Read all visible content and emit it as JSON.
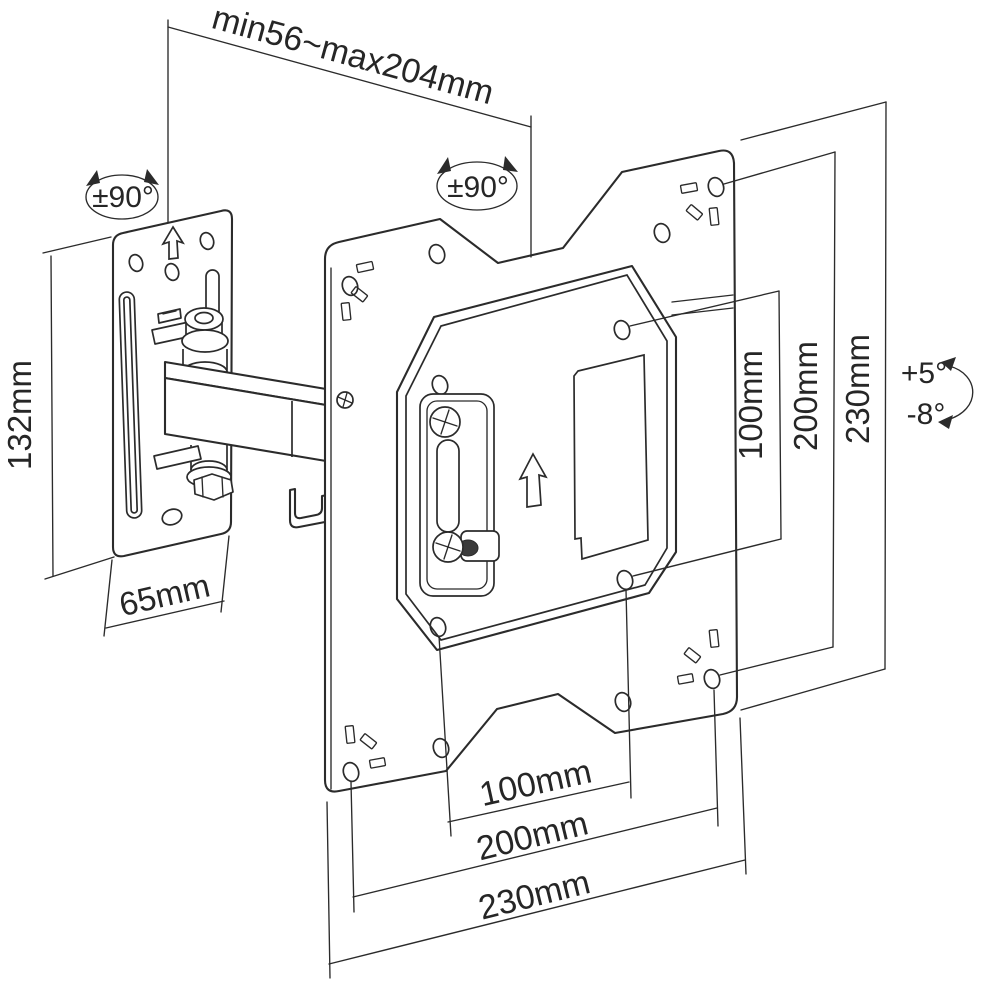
{
  "drawing": {
    "background": "#ffffff",
    "line_color": "#2b2b2b",
    "dimensions": {
      "top_span": {
        "label": "min56~max204mm"
      },
      "left_height": {
        "label": "132mm"
      },
      "left_width": {
        "label": "65mm"
      },
      "right_vertical": [
        {
          "label": "100mm"
        },
        {
          "label": "200mm"
        },
        {
          "label": "230mm"
        }
      ],
      "bottom_horizontal": [
        {
          "label": "100mm"
        },
        {
          "label": "200mm"
        },
        {
          "label": "230mm"
        }
      ]
    },
    "annotations": {
      "swivel_wall_plate": {
        "label": "±90°"
      },
      "swivel_vesa_plate": {
        "label": "±90°"
      },
      "tilt_up": {
        "label": "+5°"
      },
      "tilt_down": {
        "label": "-8°"
      }
    }
  }
}
